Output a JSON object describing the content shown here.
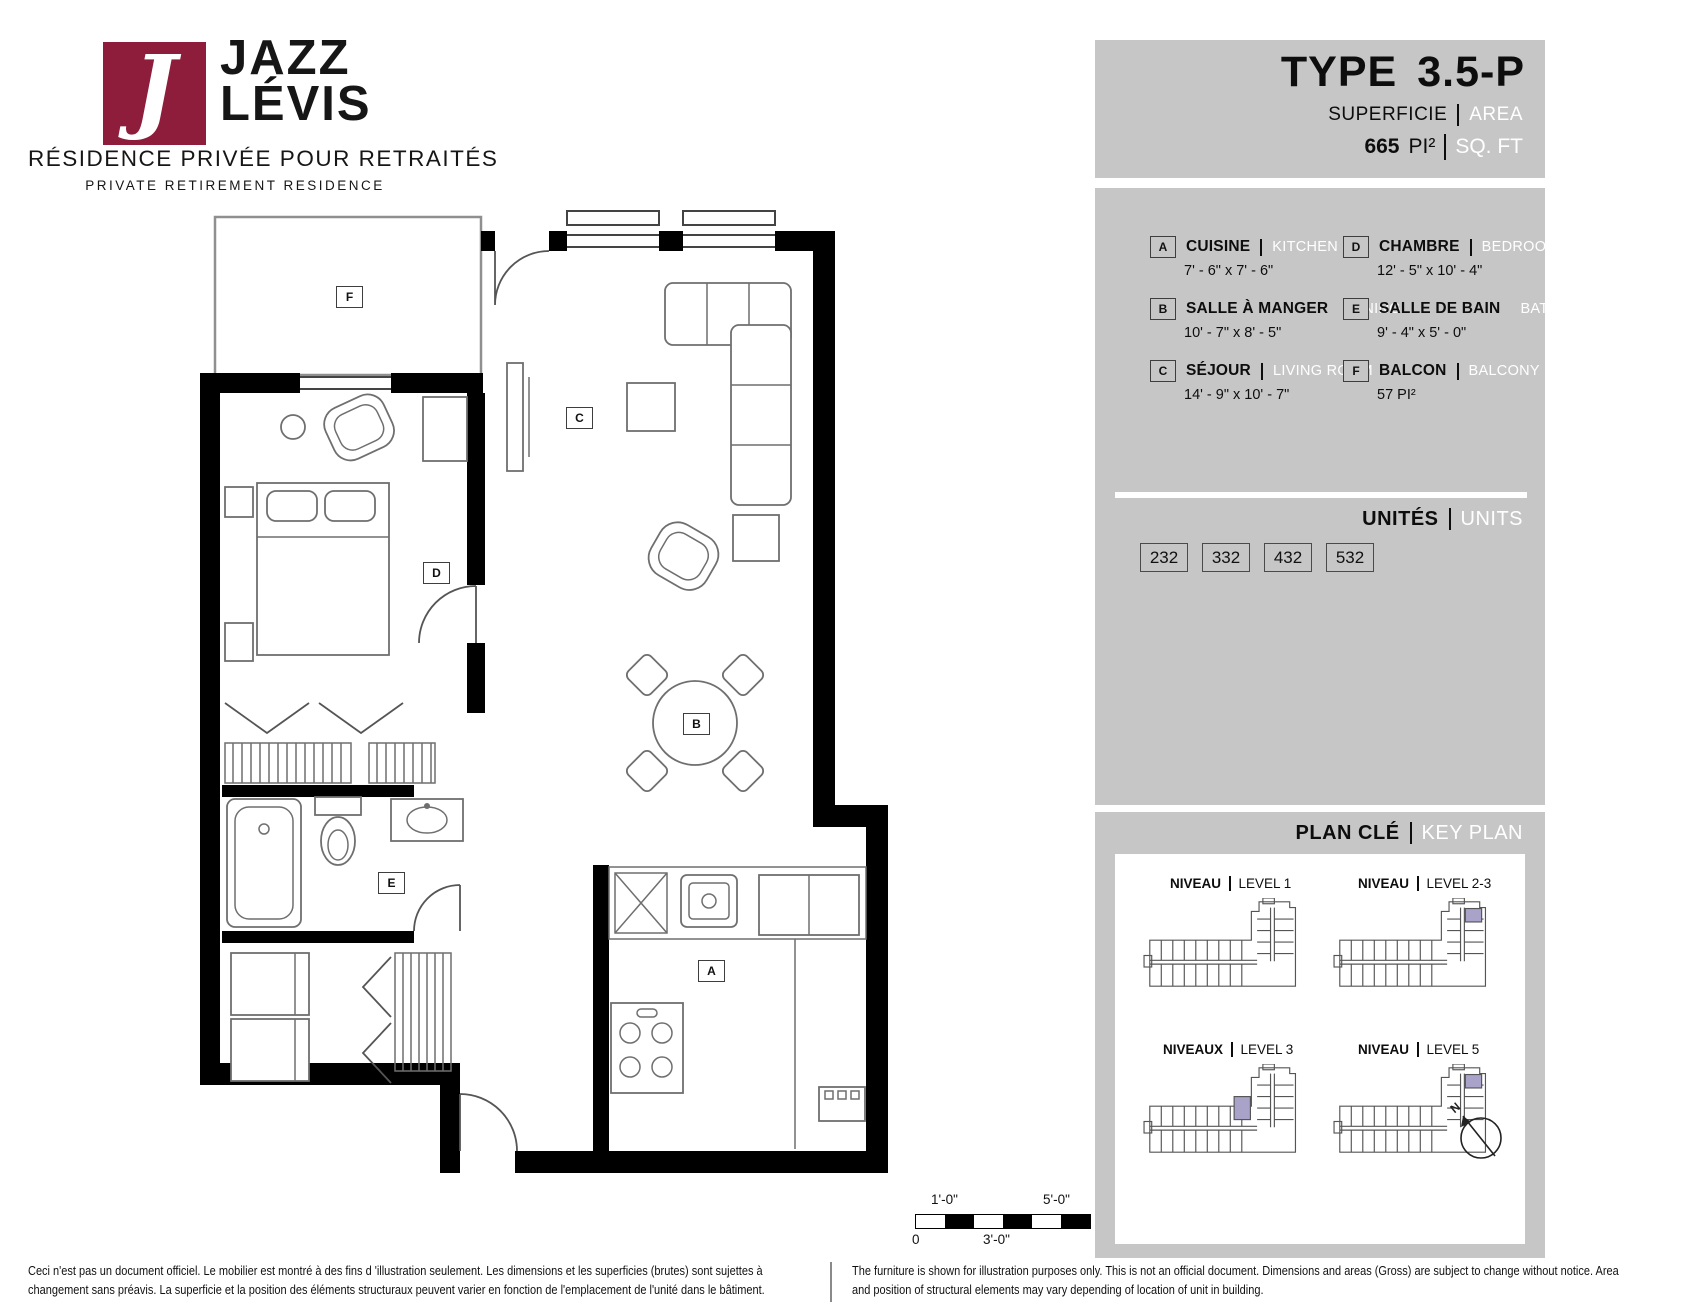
{
  "brand": {
    "monogram": "J",
    "name_line1": "JAZZ",
    "name_line2": "LÉVIS",
    "tagline_fr": "RÉSIDENCE PRIVÉE POUR RETRAITÉS",
    "tagline_en": "PRIVATE RETIREMENT RESIDENCE"
  },
  "header": {
    "type_word": "TYPE",
    "type_code": "3.5-P",
    "area_label_fr": "SUPERFICIE",
    "area_label_en": "AREA",
    "area_value": "665",
    "area_unit_fr": "PI²",
    "area_unit_en": "SQ. FT"
  },
  "legend": {
    "rooms": [
      {
        "key": "A",
        "name_fr": "CUISINE",
        "name_en": "KITCHEN",
        "dims": "7' - 6\" x 7' - 6\""
      },
      {
        "key": "B",
        "name_fr": "SALLE À MANGER",
        "name_en": "DINING",
        "dims": "10' - 7\" x 8' - 5\""
      },
      {
        "key": "C",
        "name_fr": "SÉJOUR",
        "name_en": "LIVING ROOM",
        "dims": "14' - 9\" x 10' - 7\""
      },
      {
        "key": "D",
        "name_fr": "CHAMBRE",
        "name_en": "BEDROOM",
        "dims": "12' - 5\" x 10' - 4\""
      },
      {
        "key": "E",
        "name_fr": "SALLE DE BAIN",
        "name_en": "BATHROOM",
        "dims": "9' - 4\" x 5' - 0\""
      },
      {
        "key": "F",
        "name_fr": "BALCON",
        "name_en": "BALCONY",
        "dims": "57 PI²"
      }
    ]
  },
  "units": {
    "label_fr": "UNITÉS",
    "label_en": "UNITS",
    "numbers": [
      "232",
      "332",
      "432",
      "532"
    ]
  },
  "key_plan": {
    "label_fr": "PLAN CLÉ",
    "label_en": "KEY PLAN",
    "north_label": "N",
    "levels": [
      {
        "label_fr": "NIVEAU",
        "label_en": "LEVEL 1"
      },
      {
        "label_fr": "NIVEAU",
        "label_en": "LEVEL 2-3"
      },
      {
        "label_fr": "NIVEAUX",
        "label_en": "LEVEL 3"
      },
      {
        "label_fr": "NIVEAU",
        "label_en": "LEVEL 5"
      }
    ]
  },
  "scale_bar": {
    "tick_0": "0",
    "tick_1": "1'-0\"",
    "tick_3": "3'-0\"",
    "tick_5": "5'-0\""
  },
  "footer": {
    "fr": "Ceci n'est pas un document officiel.  Le mobilier est montré à des fins d 'illustration seulement.  Les dimensions et les superficies (brutes) sont sujettes à changement sans préavis. La superficie et la position des éléments structuraux peuvent varier en fonction de l'emplacement de l'unité dans le bâtiment.",
    "en": "The furniture is shown for illustration purposes only.  This is not an official document.  Dimensions and areas (Gross) are subject to change without notice. Area and position of structural elements may vary depending of location of unit in building."
  },
  "colors": {
    "brand_red": "#8e1c3b",
    "panel_gray": "#c6c6c6",
    "highlight_purple": "#a9a3c9"
  }
}
